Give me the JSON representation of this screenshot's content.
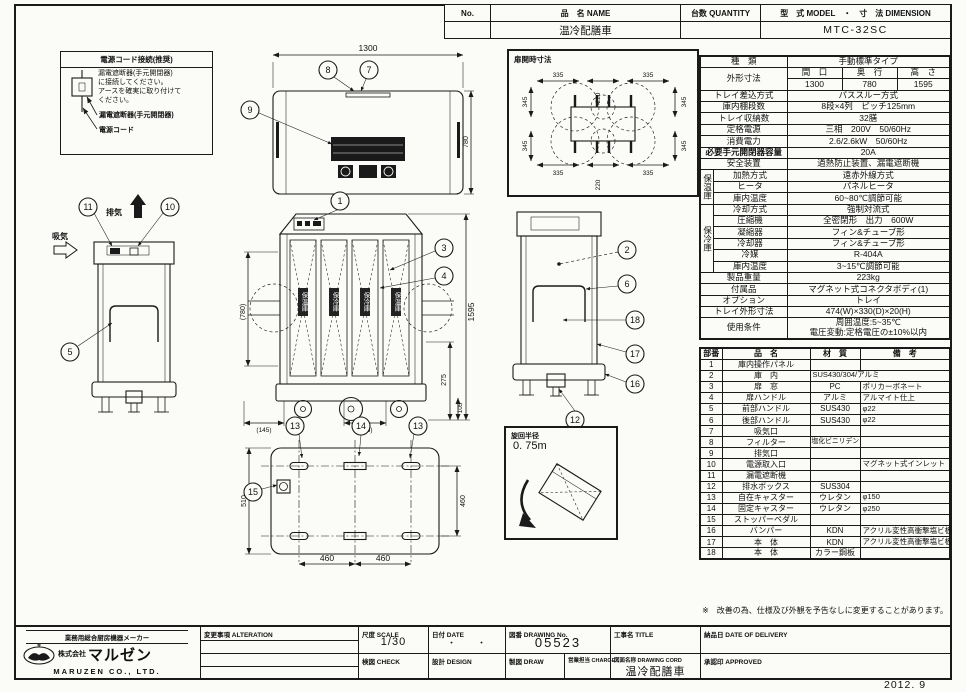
{
  "header": {
    "no_label": "No.",
    "name_label": "品　名 NAME",
    "qty_label": "台数 QUANTITY",
    "model_label": "型　式 MODEL　・　寸　法 DIMENSION",
    "product_name": "温冷配膳車",
    "qty_value": "",
    "model_value": "MTC-32SC"
  },
  "power_note": {
    "title": "電源コード接続(推奨)",
    "body": "漏電遮断器(手元開閉器)\nに接続してください。\nアースを確実に取り付けて\nください。",
    "breaker_label": "漏電遮断器(手元開閉器)",
    "cord_label": "電源コード"
  },
  "spec": {
    "group_hot": "保温庫",
    "group_cold": "保冷庫",
    "rows": [
      {
        "label": "種　類",
        "value": "手動標準タイプ"
      },
      {
        "label": "外形寸法",
        "c1": "間　口",
        "c2": "奥　行",
        "c3": "高　さ",
        "v1": "1300",
        "v2": "780",
        "v3": "1595"
      },
      {
        "label": "トレイ差込方式",
        "value": "パススルー方式"
      },
      {
        "label": "庫内棚段数",
        "value": "8段×4列　ピッチ125mm"
      },
      {
        "label": "トレイ収納数",
        "value": "32膳"
      },
      {
        "label": "定格電源",
        "value": "三相　200V　50/60Hz"
      },
      {
        "label": "消費電力",
        "value": "2.6/2.6kW　50/60Hz"
      },
      {
        "label": "必要手元開閉器容量",
        "value": "20A"
      },
      {
        "label": "安全装置",
        "value": "過熱防止装置、漏電遮断機"
      },
      {
        "label": "加熱方式",
        "value": "遠赤外線方式"
      },
      {
        "label": "ヒータ",
        "value": "パネルヒータ"
      },
      {
        "label": "庫内温度",
        "value": "60~80℃調節可能"
      },
      {
        "label": "冷却方式",
        "value": "強制対流式"
      },
      {
        "label": "圧縮機",
        "value": "全密閉形　出力　600W"
      },
      {
        "label": "凝縮器",
        "value": "フィン&チューブ形"
      },
      {
        "label": "冷却器",
        "value": "フィン&チューブ形"
      },
      {
        "label": "冷媒",
        "value": "R-404A"
      },
      {
        "label": "庫内温度",
        "value": "3~15℃調節可能"
      },
      {
        "label": "製品重量",
        "value": "223kg"
      },
      {
        "label": "付属品",
        "value": "マグネット式コネクタボディ(1)"
      },
      {
        "label": "オプション",
        "value": "トレイ"
      },
      {
        "label": "トレイ外形寸法",
        "value": "474(W)×330(D)×20(H)"
      },
      {
        "label": "使用条件",
        "value": "周囲温度:5~35℃\n電圧変動:定格電圧の±10%以内"
      }
    ]
  },
  "parts": {
    "headers": [
      "部番",
      "品　名",
      "材　質",
      "備　考"
    ],
    "rows": [
      [
        "1",
        "庫内操作パネル",
        "",
        ""
      ],
      [
        "2",
        "庫　内",
        "SUS430/304/アルミ",
        ""
      ],
      [
        "3",
        "扉　窓",
        "PC",
        "ポリカーボネート"
      ],
      [
        "4",
        "扉ハンドル",
        "アルミ",
        "アルマイト仕上"
      ],
      [
        "5",
        "前部ハンドル",
        "SUS430",
        "φ22"
      ],
      [
        "6",
        "後部ハンドル",
        "SUS430",
        "φ22"
      ],
      [
        "7",
        "吸気口",
        "",
        ""
      ],
      [
        "8",
        "フィルター",
        "塩化ビニリデン",
        ""
      ],
      [
        "9",
        "排気口",
        "",
        ""
      ],
      [
        "10",
        "電源取入口",
        "",
        "マグネット式インレット"
      ],
      [
        "11",
        "漏電遮断機",
        "",
        ""
      ],
      [
        "12",
        "排水ボックス",
        "SUS304",
        ""
      ],
      [
        "13",
        "自在キャスター",
        "ウレタン",
        "φ150"
      ],
      [
        "14",
        "固定キャスター",
        "ウレタン",
        "φ250"
      ],
      [
        "15",
        "ストッパーペダル",
        "",
        ""
      ],
      [
        "16",
        "バンパー",
        "KDN",
        "アクリル変性高衝撃塩ビ板"
      ],
      [
        "17",
        "本　体",
        "KDN",
        "アクリル変性高衝撃塩ビ板"
      ],
      [
        "18",
        "本　体",
        "カラー鋼板",
        ""
      ]
    ]
  },
  "balloons": {
    "n1": "1",
    "n2": "2",
    "n3": "3",
    "n4": "4",
    "n5": "5",
    "n6": "6",
    "n7": "7",
    "n8": "8",
    "n9": "9",
    "n10": "10",
    "n11": "11",
    "n12": "12",
    "n13": "13",
    "n14": "14",
    "n15": "15",
    "n16": "16",
    "n17": "17",
    "n18": "18"
  },
  "dims": {
    "w1300": "1300",
    "d780": "780",
    "h1595": "1595",
    "hp780": "(780)",
    "v275": "275",
    "v105": "105",
    "p145": "(145)",
    "d335": "335",
    "d220": "220",
    "d345": "345",
    "b510": "510",
    "b460": "460"
  },
  "views": {
    "door_open_title": "扉開時寸法",
    "turning_label": "旋回半径",
    "turning_value": "0. 75m",
    "exhaust": "排気",
    "intake": "吸気",
    "door_labels": [
      "保温庫",
      "保冷庫",
      "保冷庫",
      "保温庫"
    ]
  },
  "footer": {
    "maker_line": "業務用総合厨房機器メーカー",
    "company_prefix": "株式会社",
    "company_name": "マルゼン",
    "company_en": "MARUZEN CO., LTD.",
    "alteration_label": "変更事項 ALTERATION",
    "scale_label": "尺度 SCALE",
    "scale_value": "1/30",
    "date_label": "日付 DATE",
    "date_value": "・　　・",
    "check_label": "検図 CHECK",
    "design_label": "設計 DESIGN",
    "draw_label": "製図 DRAW",
    "charge_label": "営業担当 CHARGE",
    "drawing_no_label": "図番 DRAWING No.",
    "drawing_no": "05523",
    "title_label": "工事名 TITLE",
    "drawing_name_label": "図面名称 DRAWING CORD",
    "drawing_name": "温冷配膳車",
    "delivery_label": "納品日 DATE OF DELIVERY",
    "approved_label": "承認印 APPROVED"
  },
  "note": "※　改善の為、仕様及び外観を予告なしに変更することがあります。",
  "issue_date": "2012. 9"
}
